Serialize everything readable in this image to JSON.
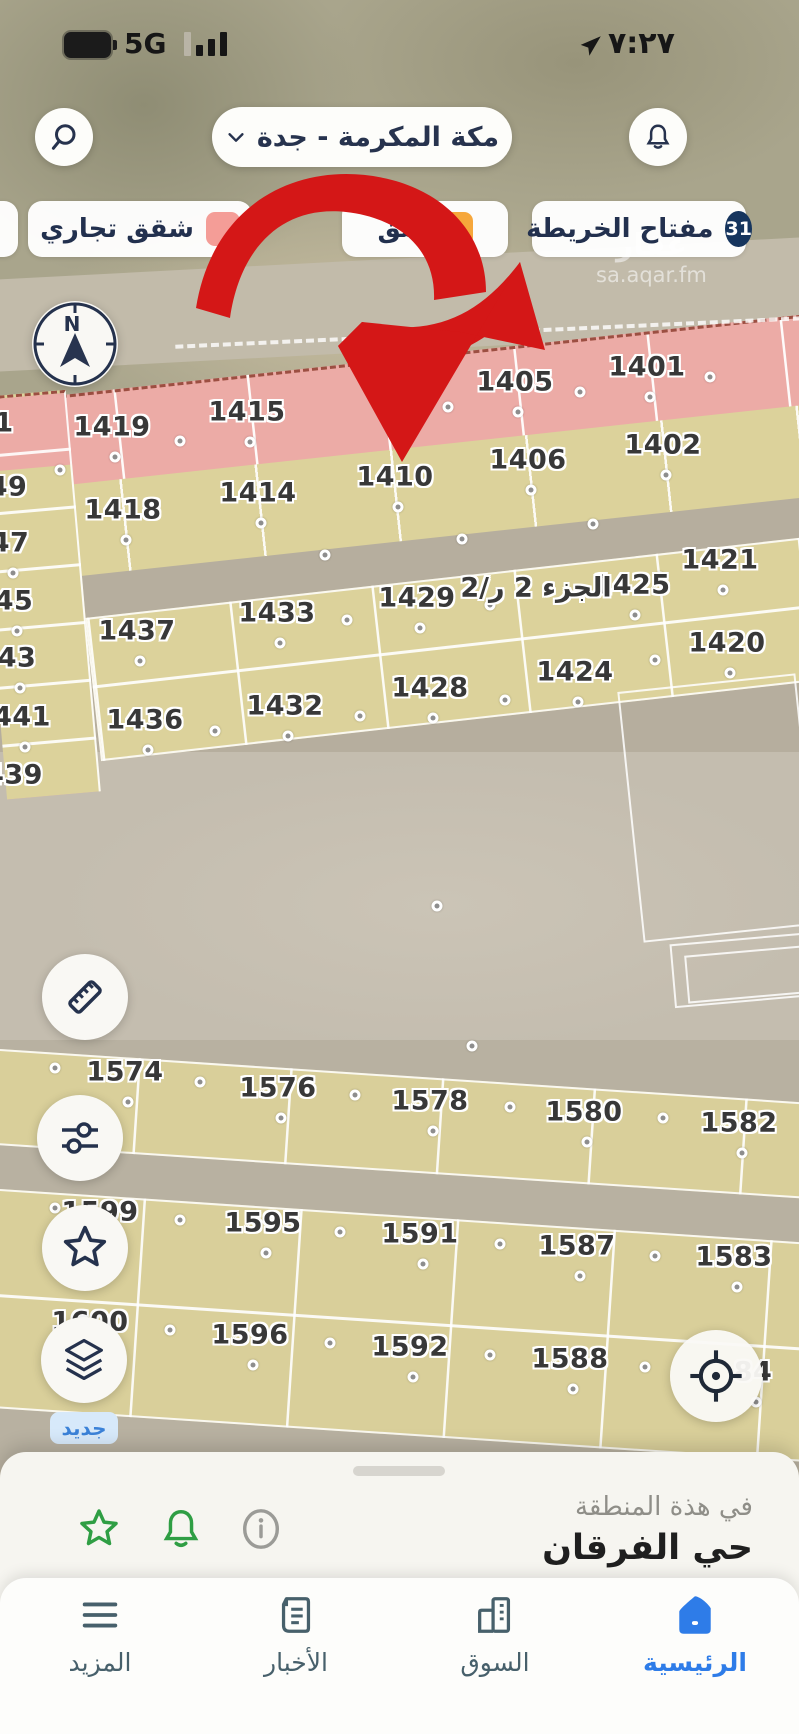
{
  "status_bar": {
    "network": "5G",
    "time": "٧:٢٧"
  },
  "header": {
    "location_selector": "مكة المكرمة - جدة"
  },
  "legend": {
    "key_chip": {
      "label": "مفتاح الخريطة",
      "count": "31"
    },
    "chips": [
      {
        "label": "شق",
        "color": "#f6a73b"
      },
      {
        "label": "شقق تجاري",
        "color": "#f49d97"
      },
      {
        "label": "",
        "color": "#f49d97"
      }
    ]
  },
  "watermark": {
    "brand": "عقار",
    "url": "sa.aqar.fm"
  },
  "compass": {
    "north": "N"
  },
  "map": {
    "plots": [
      "1401",
      "1405",
      "1415",
      "1419",
      "1",
      "1402",
      "1406",
      "1410",
      "1414",
      "1418",
      "49",
      "47",
      "45",
      "43",
      "441",
      "439",
      "1421",
      "1425",
      "الجزء 2 ر/2",
      "1429",
      "1433",
      "1437",
      "1420",
      "1424",
      "1428",
      "1432",
      "1436",
      "1574",
      "1576",
      "1578",
      "1580",
      "1582",
      "1599",
      "1595",
      "1591",
      "1587",
      "1583",
      "1600",
      "1596",
      "1592",
      "1588",
      "84"
    ]
  },
  "tools": {
    "new_badge": "جديد"
  },
  "bottom_sheet": {
    "context_label": "في هذة المنطقة",
    "district": "حي الفرقان"
  },
  "nav": {
    "items": [
      {
        "label": "الرئيسية",
        "active": true
      },
      {
        "label": "السوق",
        "active": false
      },
      {
        "label": "الأخبار",
        "active": false
      },
      {
        "label": "المزيد",
        "active": false
      }
    ]
  }
}
